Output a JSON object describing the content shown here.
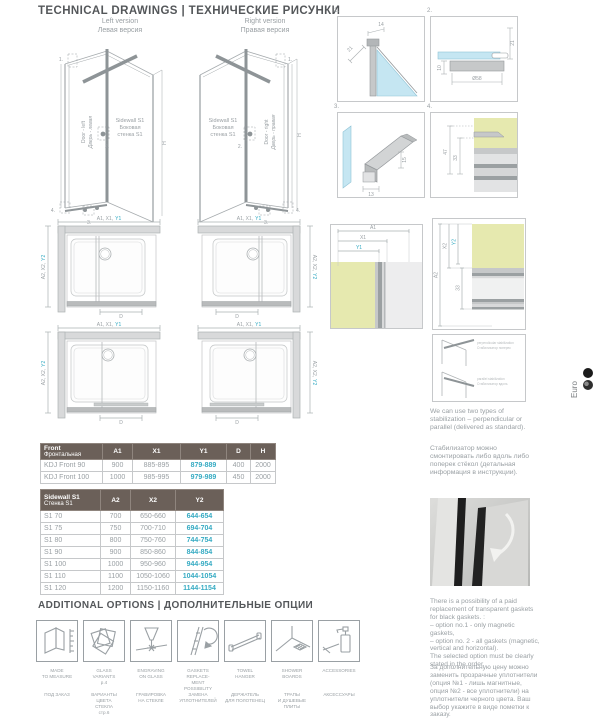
{
  "header": {
    "title": "TECHNICAL DRAWINGS | ТЕХНИЧЕСКИЕ РИСУНКИ"
  },
  "drawings3d": {
    "left": {
      "version_en": "Left version",
      "version_ru": "Левая версия",
      "door_en": "Door - left",
      "door_ru": "Дверь - левая",
      "sidewall_l1": "Sidewall S1",
      "sidewall_l2": "Боковая",
      "sidewall_l3": "стенка S1",
      "h": "H",
      "r1": "1.",
      "r2": "2.",
      "r3": "3.",
      "r4": "4."
    },
    "right": {
      "version_en": "Right version",
      "version_ru": "Правая версия",
      "door_en": "Door - right",
      "door_ru": "Дверь - правая",
      "sidewall_l1": "Sidewall S1",
      "sidewall_l2": "Боковая",
      "sidewall_l3": "стенка S1",
      "h": "H",
      "r1": "1.",
      "r2": "2.",
      "r3": "3.",
      "r4": "4."
    }
  },
  "details": {
    "d1": {
      "num": "1.",
      "dim_a": "14",
      "dim_b": "21"
    },
    "d2": {
      "num": "2.",
      "dim_a": "21",
      "dim_b": "10",
      "diameter": "Ø58"
    },
    "d3": {
      "num": "3.",
      "dim_a": "15",
      "dim_b": "13"
    },
    "d4": {
      "num": "4.",
      "dim_a": "47",
      "dim_b": "33"
    }
  },
  "plans": {
    "top_a": "A1, X1,",
    "top_y": "Y1",
    "side_a": "A2, X2,",
    "side_y": "Y2",
    "d": "D"
  },
  "measures": {
    "front": {
      "a1": "A1",
      "x1": "X1",
      "y1": "Y1"
    },
    "side": {
      "a2": "A2",
      "x2": "X2",
      "y2": "Y2",
      "inner": "33"
    }
  },
  "stabilization": {
    "s1_en": "perpendicular stabilization",
    "s1_ru": "Стабилизатор поперек",
    "s2_en": "parallel stabilization",
    "s2_ru": "Стабилизатор вдоль",
    "caption_en": "We can use two types of stabilization – perpendicular or parallel (delivered as standard).",
    "caption_ru": "Стабилизатор можно смонтировать либо вдоль либо поперек стёкол (детальная информация в инструкции)."
  },
  "gaskets": {
    "note_en": "There is a possibility of a paid replacement of transparent gaskets for black gaskets. :\n– option no.1 - only magnetic gaskets,\n– option no. 2 - all gaskets (magnetic, vertical and horizontal).\nThe selected option must be clearly stated in the order.",
    "note_ru": "За дополнительную цену можно заменить прозрачные уплотнители (опция №1 - лишь магнитные, опция №2 - все уплотнители) на уплотнители черного цвета. Ваш выбор укажите в виде пометки к заказу."
  },
  "front_table": {
    "title_en": "Front",
    "title_ru": "Фронтальная",
    "col_a1": "A1",
    "col_x1": "X1",
    "col_y1": "Y1",
    "col_d": "D",
    "col_h": "H",
    "rows": [
      {
        "name": "KDJ Front 90",
        "a1": "900",
        "x1": "885-895",
        "y1": "879-889",
        "d": "400",
        "h": "2000"
      },
      {
        "name": "KDJ Front 100",
        "a1": "1000",
        "x1": "985-995",
        "y1": "979-989",
        "d": "450",
        "h": "2000"
      }
    ]
  },
  "sidewall_table": {
    "title_en": "Sidewall S1",
    "title_ru": "Стенка S1",
    "col_a2": "A2",
    "col_x2": "X2",
    "col_y2": "Y2",
    "rows": [
      {
        "name": "S1 70",
        "a2": "700",
        "x2": "650-660",
        "y2": "644-654"
      },
      {
        "name": "S1 75",
        "a2": "750",
        "x2": "700-710",
        "y2": "694-704"
      },
      {
        "name": "S1 80",
        "a2": "800",
        "x2": "750-760",
        "y2": "744-754"
      },
      {
        "name": "S1 90",
        "a2": "900",
        "x2": "850-860",
        "y2": "844-854"
      },
      {
        "name": "S1 100",
        "a2": "1000",
        "x2": "950-960",
        "y2": "944-954"
      },
      {
        "name": "S1 110",
        "a2": "1100",
        "x2": "1050-1060",
        "y2": "1044-1054"
      },
      {
        "name": "S1 120",
        "a2": "1200",
        "x2": "1150-1160",
        "y2": "1144-1154"
      }
    ]
  },
  "options": {
    "title": "ADDITIONAL OPTIONS | ДОПОЛНИТЕЛЬНЫЕ ОПЦИИ",
    "items": [
      {
        "en": "MADE\nTO MEASURE",
        "sub_en": "",
        "ru": "ПОД ЗАКАЗ",
        "sub_ru": ""
      },
      {
        "en": "GLASS\nVARIANTS",
        "sub_en": "p.4",
        "ru": "ВАРИАНТЫ ЦВЕТА\nСТЕКЛА",
        "sub_ru": "стр.6"
      },
      {
        "en": "ENGRAVING\nON GLASS",
        "sub_en": "",
        "ru": "ГРАВИРОВКА\nНА СТЕКЛЕ",
        "sub_ru": ""
      },
      {
        "en": "GASKETS REPLACE-\nMENT POSSIBILITY",
        "sub_en": "",
        "ru": "ЗАМЕНА\nУПЛОТНИТЕЛЕЙ",
        "sub_ru": ""
      },
      {
        "en": "TOWEL\nHANGER",
        "sub_en": "",
        "ru": "ДЕРЖАТЕЛЬ\nДЛЯ ПОЛОТЕНЕЦ",
        "sub_ru": ""
      },
      {
        "en": "SHOWER\nBOARDS",
        "sub_en": "",
        "ru": "ТРАПЫ\nИ ДУШЕВЫЕ\nПЛИТЫ",
        "sub_ru": ""
      },
      {
        "en": "ACCESSORIES",
        "sub_en": "",
        "ru": "АКСЕССУАРЫ",
        "sub_ru": ""
      }
    ]
  },
  "euro": {
    "label": "Euro"
  },
  "colors": {
    "accent": "#36abc3",
    "table_header": "#6b6059",
    "line": "#9aa0a4",
    "glass_blue": "#c5e6f2",
    "wall_green": "#e6e9af"
  }
}
